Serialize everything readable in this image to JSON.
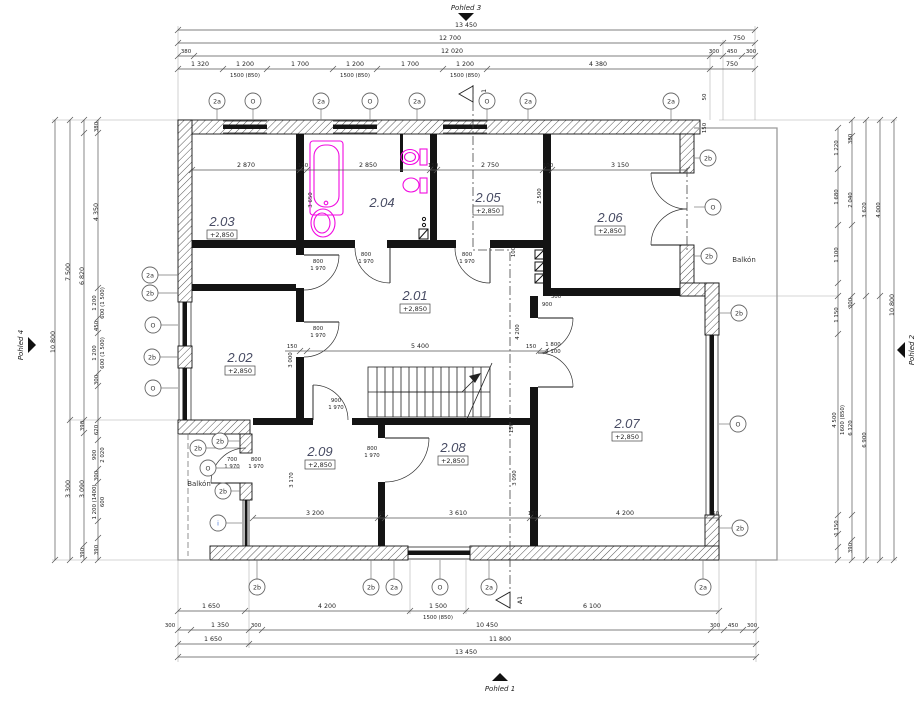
{
  "views": {
    "p1": "Pohled 1",
    "p2": "Pohled 2",
    "p3": "Pohled 3",
    "p4": "Pohled 4"
  },
  "section": {
    "top": "A 1",
    "bottom": "A1"
  },
  "balcony": {
    "right": "Balkón",
    "left": "Balkón"
  },
  "rooms": [
    {
      "id": "2.01",
      "elev": "+2,850"
    },
    {
      "id": "2.02",
      "elev": "+2,850"
    },
    {
      "id": "2.03",
      "elev": "+2,850"
    },
    {
      "id": "2.04",
      "elev": ""
    },
    {
      "id": "2.05",
      "elev": "+2,850"
    },
    {
      "id": "2.06",
      "elev": "+2,850"
    },
    {
      "id": "2.07",
      "elev": "+2,850"
    },
    {
      "id": "2.08",
      "elev": "+2,850"
    },
    {
      "id": "2.09",
      "elev": "+2,850"
    }
  ],
  "axes": {
    "top": [
      "2a",
      "O",
      "2a",
      "O",
      "2a",
      "O",
      "2a",
      "2a"
    ],
    "bottom": [
      "2b",
      "2b",
      "2a",
      "O",
      "2a",
      "2a"
    ],
    "left": [
      "2a",
      "2b",
      "O",
      "2b",
      "O"
    ],
    "left_low": [
      "2b",
      "2b",
      "O",
      "2b",
      "i"
    ],
    "right": [
      "2b",
      "O",
      "2b",
      "2b",
      "O",
      "2b"
    ]
  },
  "dims": {
    "top1": [
      "13 450"
    ],
    "top2": [
      "12 700",
      "750"
    ],
    "top3": [
      "380",
      "12 020",
      "300",
      "450",
      "300"
    ],
    "top4": [
      "1 320",
      "1 200",
      "1 700",
      "1 200",
      "1 700",
      "1 200",
      "4 380",
      "750"
    ],
    "topsub": [
      "1500 (850)",
      "1500 (850)",
      "1500 (850)"
    ],
    "bot1": [
      "1 650",
      "4 200",
      "1 500",
      "6 100"
    ],
    "botsub": [
      "1500 (850)"
    ],
    "bot2": [
      "300",
      "1 350",
      "300",
      "10 450",
      "300",
      "450",
      "300"
    ],
    "bot3": [
      "1 650",
      "11 800"
    ],
    "bot4": [
      "13 450"
    ],
    "left_outer": "10 800",
    "left_mid": [
      "7 500",
      "3 300"
    ],
    "left_mid2": [
      "6 820",
      "390",
      "3 090",
      "390"
    ],
    "left_inner": [
      "380",
      "4 350",
      "1 200",
      "600 (1 500)",
      "450",
      "1 200",
      "600 (1 500)",
      "300",
      "620",
      "900",
      "2 020",
      "300",
      "1 200 (1400)",
      "600",
      "390"
    ],
    "right_c1": [
      "1 220",
      "1 680",
      "1 100",
      "1 150",
      "4 500",
      "1600 (850)",
      "1 150"
    ],
    "right_c2": [
      "380",
      "2 040",
      "300",
      "6 120",
      "390"
    ],
    "right_c3": [
      "3 620",
      "6 900"
    ],
    "right_c4": [
      "4 000"
    ],
    "right_outer": "10 800",
    "room_top": [
      "2 870",
      "150",
      "2 850",
      "150",
      "2 750",
      "100",
      "3 150"
    ],
    "vdims": [
      "3 650",
      "2 500",
      "4 200",
      "3 000",
      "3 170",
      "3 090",
      "150",
      "100"
    ],
    "mid": [
      "150",
      "5 400",
      "150"
    ],
    "low": [
      "3 200",
      "40",
      "3 610",
      "150",
      "4 200",
      "150"
    ],
    "small": [
      "300",
      "900",
      "50",
      "150"
    ],
    "doors": [
      [
        "800",
        "1 970"
      ],
      [
        "800",
        "1 970"
      ],
      [
        "900",
        "1 970"
      ],
      [
        "700",
        "1 970"
      ],
      [
        "800",
        "1 970"
      ],
      [
        "800",
        "1 970"
      ],
      [
        "800",
        "1 970"
      ],
      [
        "800",
        "1 970"
      ],
      [
        "1 800",
        "2 100"
      ]
    ]
  }
}
